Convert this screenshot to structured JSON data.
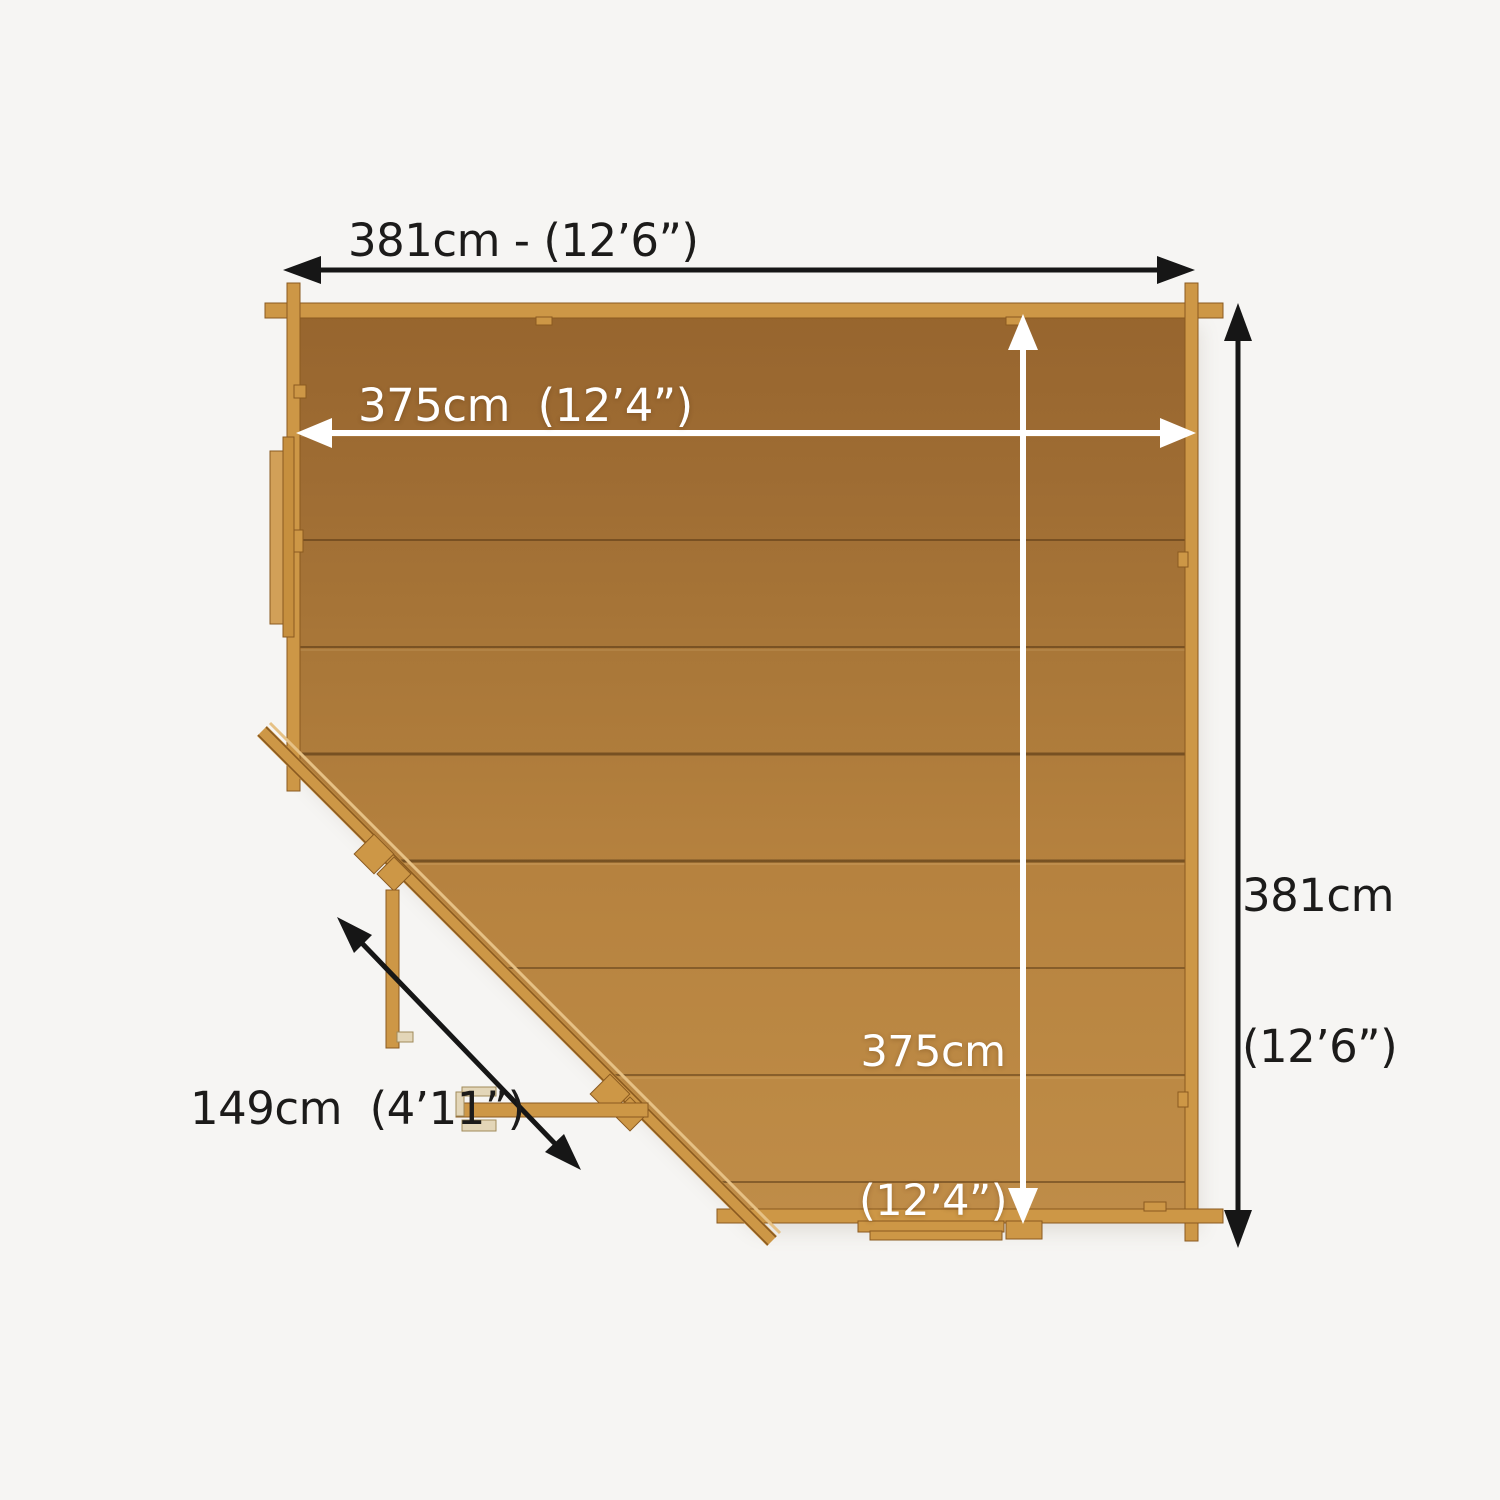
{
  "scene": {
    "background": "#f6f5f3",
    "floor_dark": "#99672f",
    "floor_mid": "#ad7a3a",
    "floor_light": "#c08c49",
    "beam": "#cd9746",
    "beam_edge": "#8a5a20",
    "window_panel": "#d2a058",
    "handle_metal": "#e3d6b8",
    "arrow_black": "#161616",
    "arrow_white": "#ffffff",
    "label_color": "#1c1b1a"
  },
  "labels": {
    "top_width": "381cm - (12’6”)",
    "inner_width": "375cm  (12’4”)",
    "right_height_line1": "381cm",
    "right_height_line2": "(12’6”)",
    "inner_height_line1": "375cm",
    "inner_height_line2": "(12’4”)",
    "door_width": "149cm  (4’11”)"
  }
}
